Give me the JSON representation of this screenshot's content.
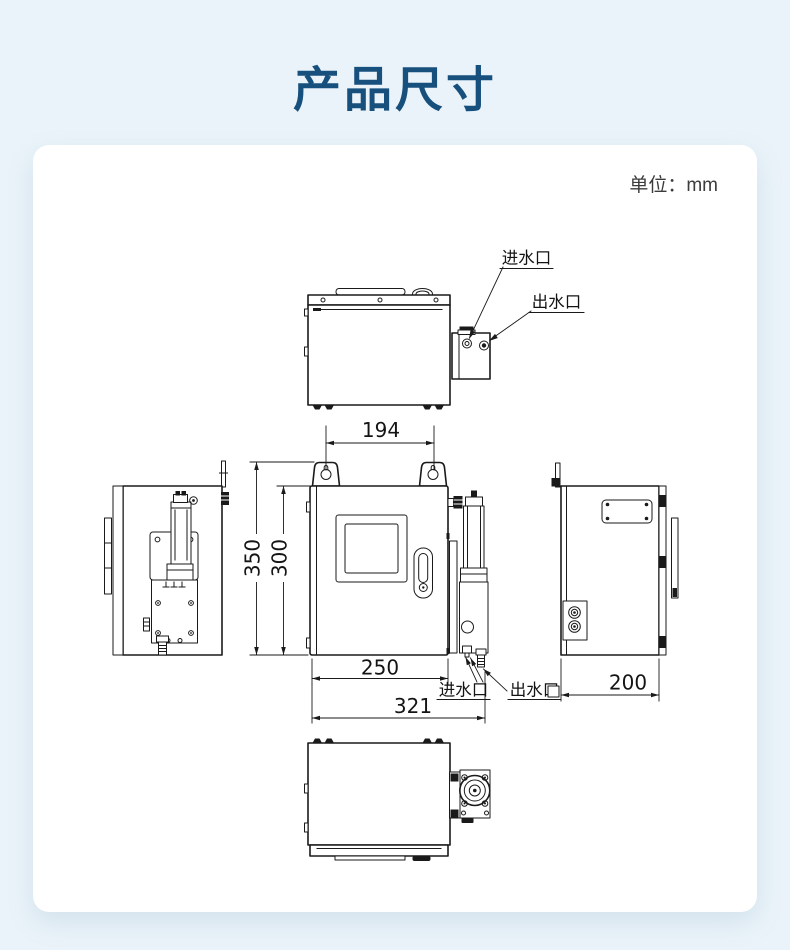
{
  "page": {
    "title": "产品尺寸",
    "unit": "单位：mm"
  },
  "drawing": {
    "dims": {
      "top_width": "194",
      "total_height": "350",
      "body_height": "300",
      "body_width": "250",
      "total_width": "321",
      "depth": "200"
    },
    "labels": {
      "top_inlet": "进水口",
      "top_outlet": "出水口",
      "bottom_inlet": "进水口",
      "bottom_outlet": "出水口"
    }
  },
  "colors": {
    "background": "#eaf3f9",
    "card": "#ffffff",
    "title": "#17507d",
    "line": "#1a1a1a"
  }
}
